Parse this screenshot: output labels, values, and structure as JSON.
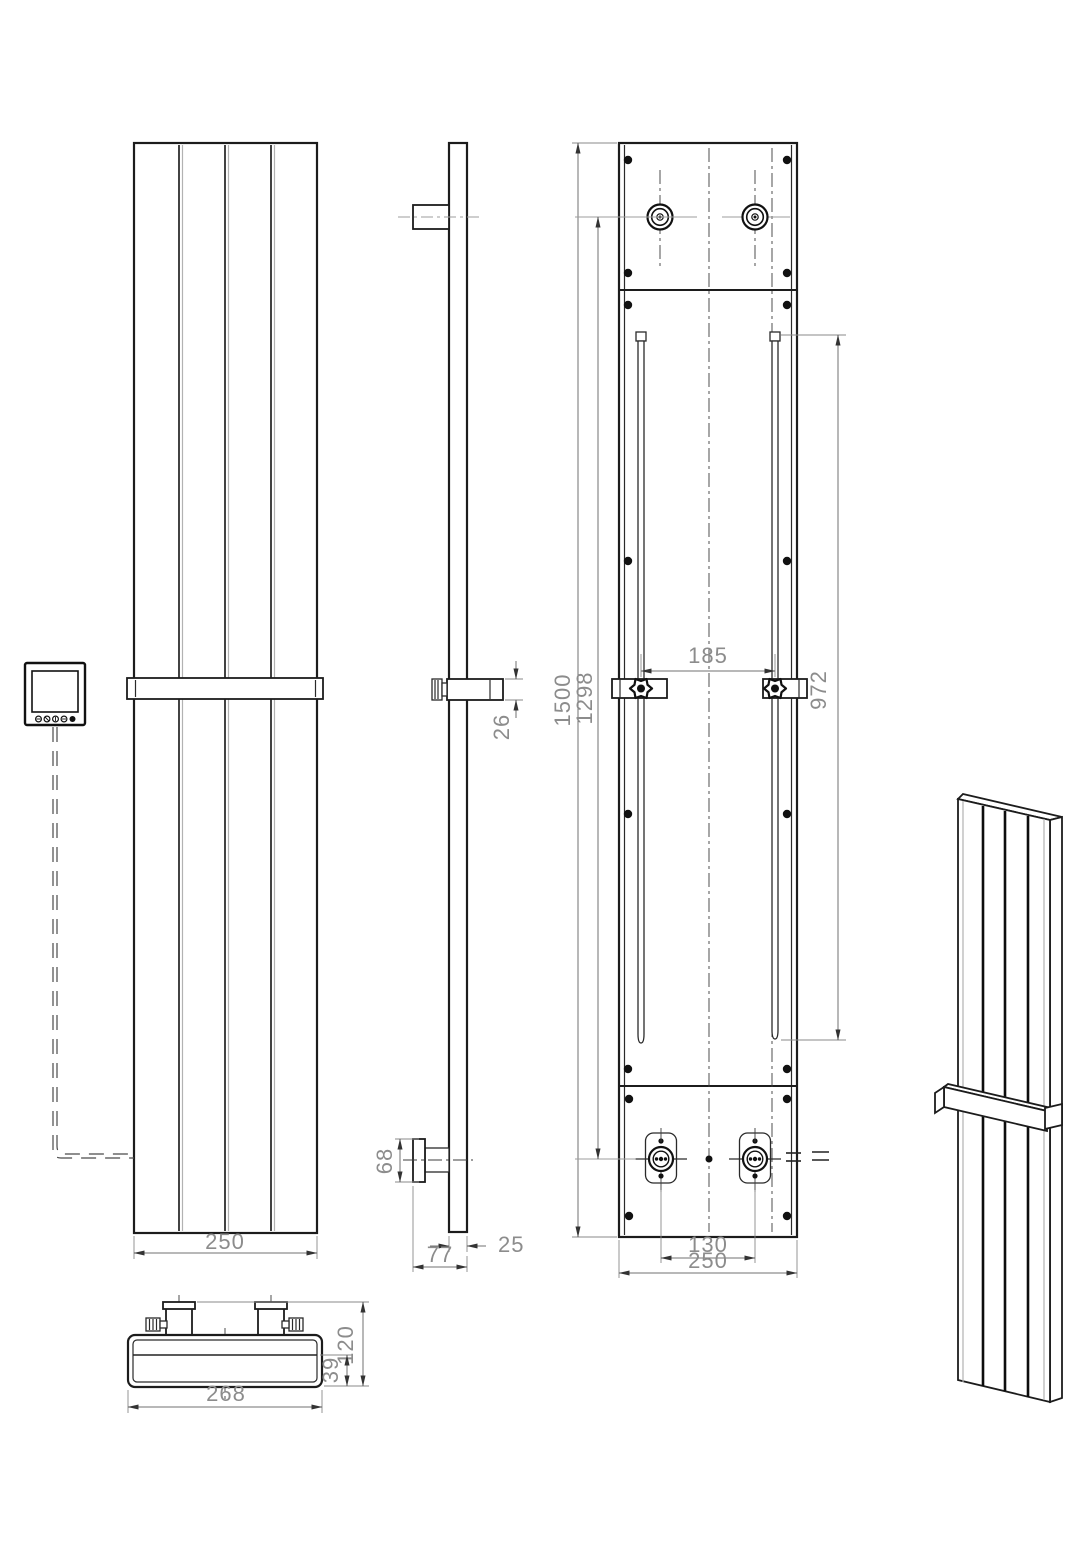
{
  "dimensions": {
    "front_view": {
      "width": "250"
    },
    "side_view": {
      "rail_height": "26",
      "bracket_height": "68",
      "panel_thickness": "25",
      "total_depth": "77"
    },
    "back_view": {
      "total_height": "1500",
      "connection_span": "1298",
      "bracket_spacing": "185",
      "slot_length": "972",
      "valve_spacing": "130",
      "width": "250"
    },
    "top_view": {
      "width": "268",
      "total_depth": "120",
      "body_depth": "39"
    }
  },
  "colors": {
    "outline": "#1c1c1c",
    "dimension_line": "#707070",
    "dimension_text": "#8c8c8c",
    "background": "#ffffff"
  }
}
